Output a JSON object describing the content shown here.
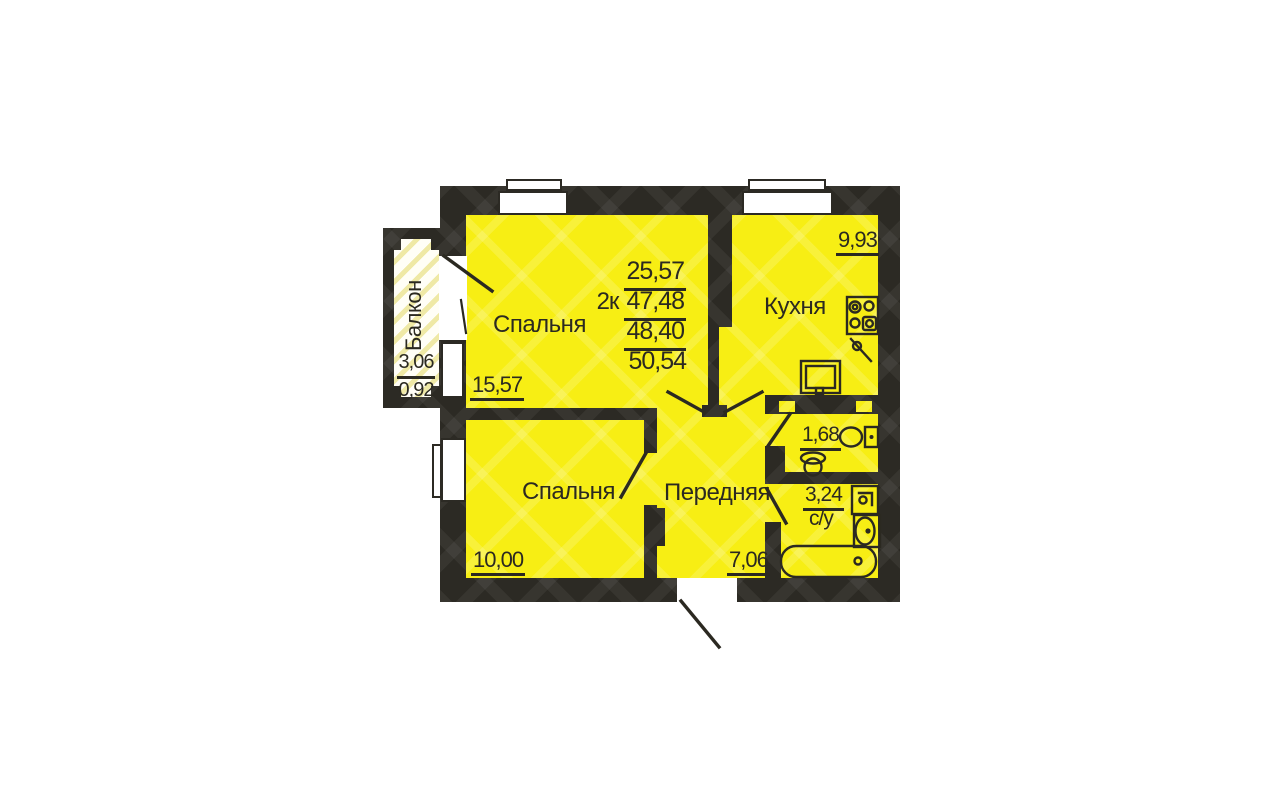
{
  "plan": {
    "summary": {
      "rooms_prefix": "2к",
      "living_area": "25,57",
      "area_47": "47,48",
      "area_48": "48,40",
      "total_area": "50,54"
    },
    "rooms": {
      "bedroom_top": {
        "label": "Спальня",
        "area": "15,57"
      },
      "bedroom_bottom": {
        "label": "Спальня",
        "area": "10,00"
      },
      "kitchen": {
        "label": "Кухня",
        "area": "9,93"
      },
      "hallway": {
        "label": "Передняя",
        "area": "7,06"
      },
      "wc": {
        "area": "1,68"
      },
      "bathroom": {
        "label": "с/у",
        "area": "3,24"
      },
      "balcony": {
        "label": "Балкон",
        "area_full": "3,06",
        "area_reduced": "0,92"
      }
    },
    "fixtures": [
      "stove-icon",
      "kitchen-sink-icon",
      "kitchen-faucet-icon",
      "toilet-icon",
      "pedestal-sink-icon",
      "washbasin-icon",
      "washing-machine-icon",
      "bathtub-icon"
    ],
    "colors": {
      "room_yellow": "#f7ee14",
      "wall_dark": "#2c2a24",
      "line_dark": "#2b2921",
      "balcony_stripe": "#efe9a6",
      "window_white": "#ffffff"
    }
  }
}
